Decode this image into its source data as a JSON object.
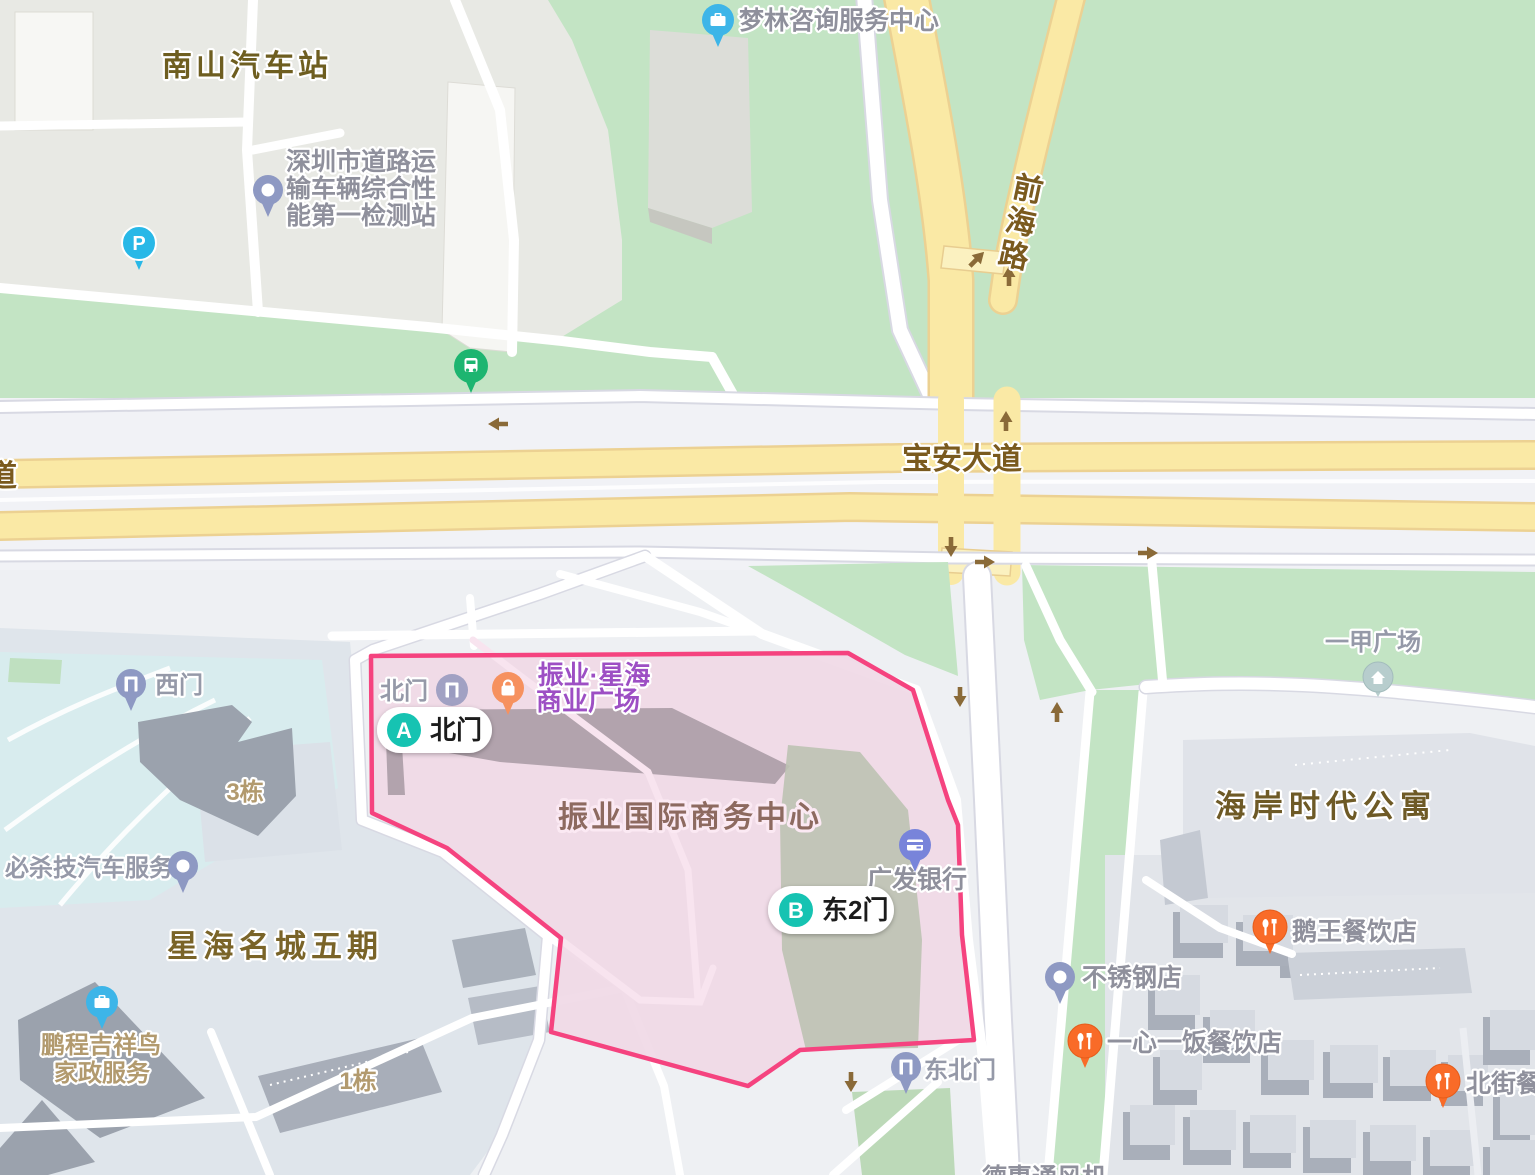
{
  "app": {
    "name": "map-view"
  },
  "colors": {
    "highlight_stroke": "#f5437f",
    "highlight_fill": "#efd8e6",
    "road_yellow": "#fae9a5",
    "green_area": "#c3e4c4",
    "pill_teal": "#14c3b2",
    "poi_orange": "#f96b28",
    "poi_blue": "#3db5e8",
    "poi_indigo": "#7884da"
  },
  "roads": {
    "baoan_avenue": "宝安大道",
    "qianhai_road": "前海路",
    "partial_left_road": "道"
  },
  "areas": {
    "nanshan_bus_station": "南山汽车站",
    "xinghai_mingcheng": "星海名城五期",
    "haian_apartments": "海岸时代公寓",
    "zhenye_center": "振业国际商务中心",
    "building_3": "3栋",
    "building_1": "1栋"
  },
  "pois": {
    "inspection_station": {
      "line1": "深圳市道路运",
      "line2": "输车辆综合性",
      "line3": "能第一检测站"
    },
    "menglin": "梦林咨询服务中心",
    "zhenye_plaza": {
      "line1": "振业·星海",
      "line2": "商业广场"
    },
    "gfbank": "广发银行",
    "yijia_plaza": "一甲广场",
    "ewang": "鹅王餐饮店",
    "stainless": "不锈钢店",
    "yixinyifan": "一心一饭餐饮店",
    "beijie": "北街餐饮",
    "bishaji": "必杀技汽车服务",
    "pengcheng": {
      "line1": "鹏程吉祥鸟",
      "line2": "家政服务"
    },
    "dehui_partial": "德惠通风机"
  },
  "gates": {
    "north_small": "北门",
    "west": "西门",
    "northeast": "东北门"
  },
  "pills": {
    "a": {
      "letter": "A",
      "label": "北门"
    },
    "b": {
      "letter": "B",
      "label": "东2门"
    }
  }
}
